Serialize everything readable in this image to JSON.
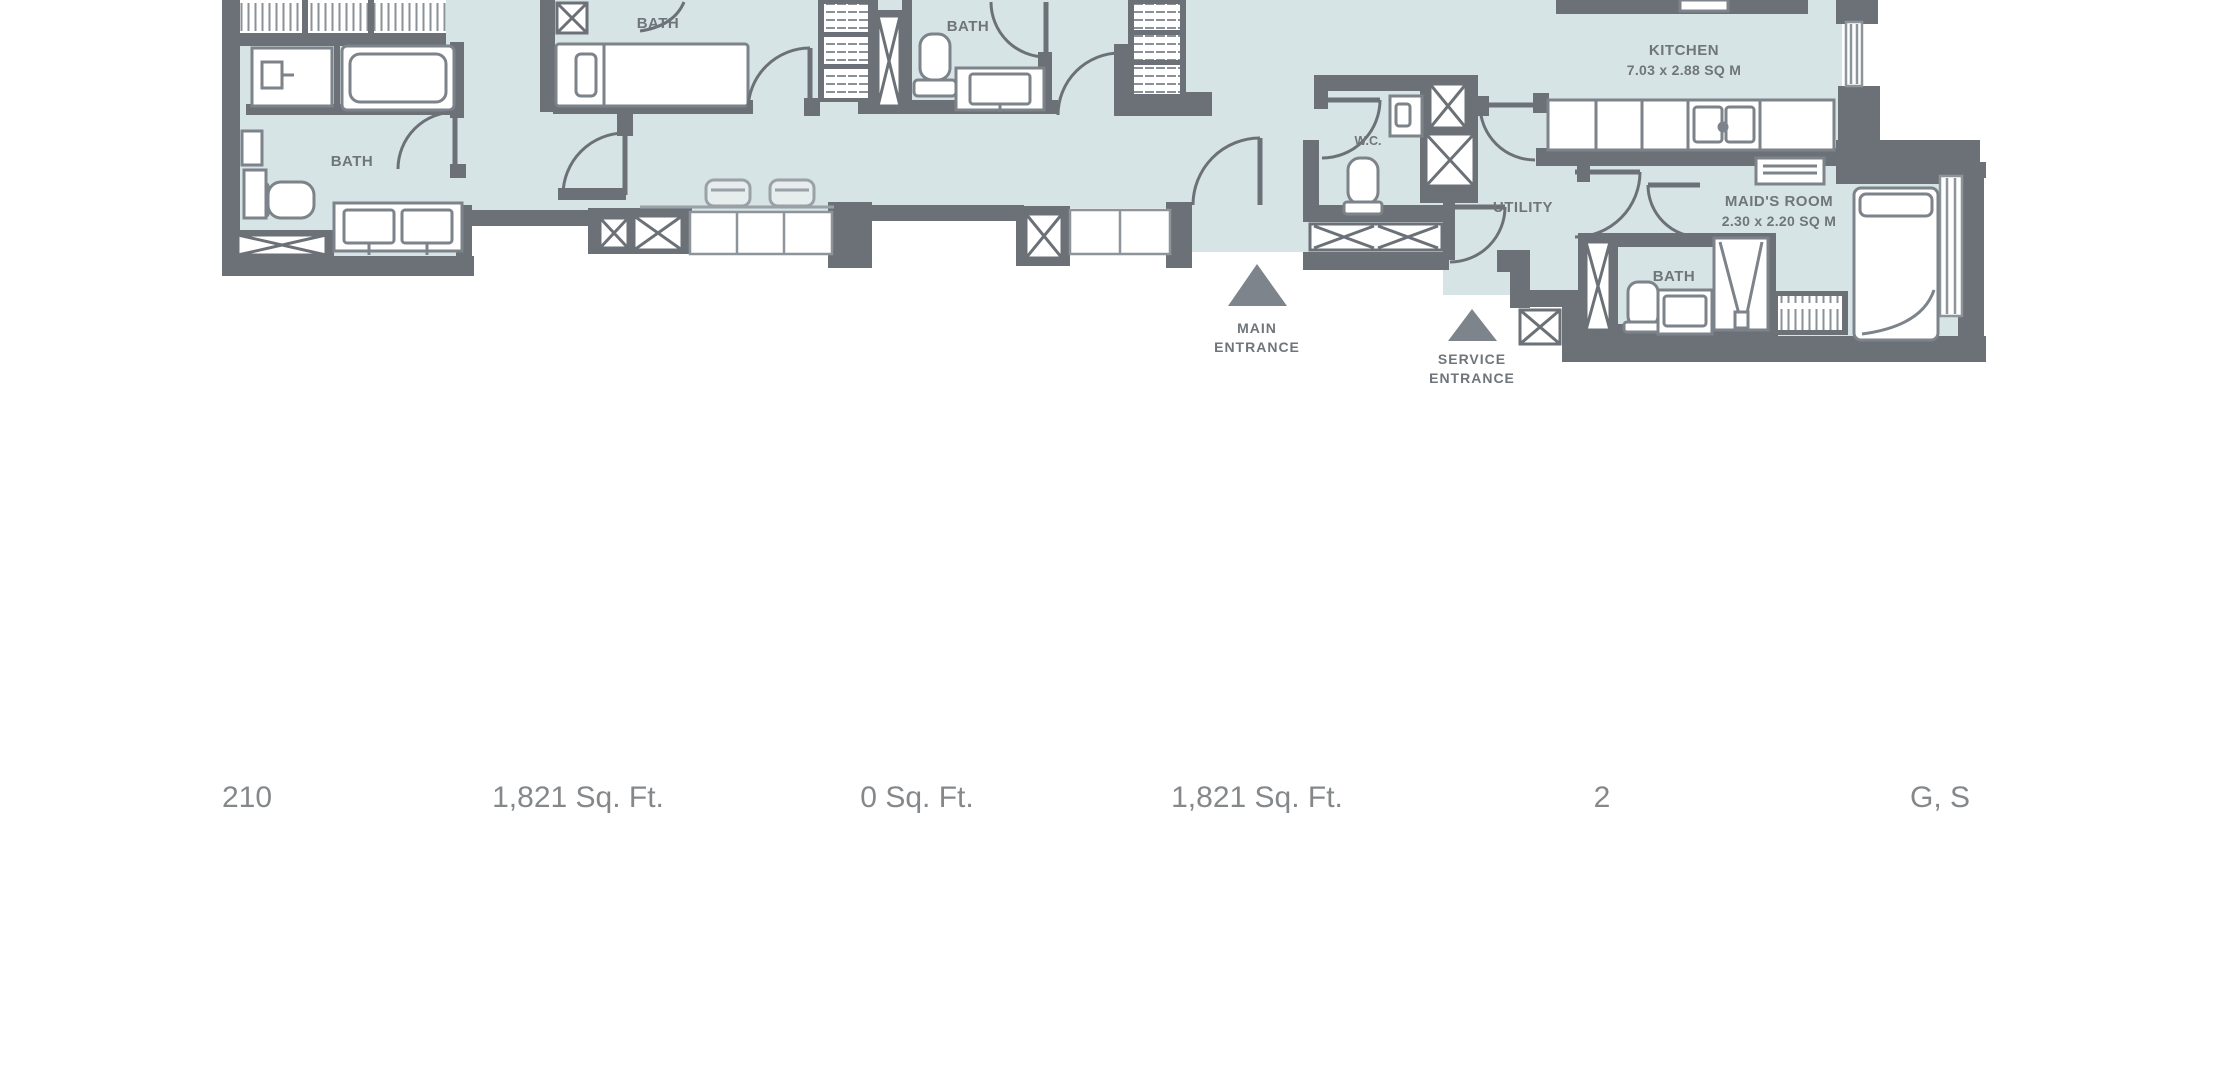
{
  "floor_plan": {
    "labels": {
      "bath_master": "BATH",
      "bath_2": "BATH",
      "bath_3": "BATH",
      "wc": "W.C.",
      "utility": "UTILITY",
      "kitchen_name": "KITCHEN",
      "kitchen_dims": "7.03 x 2.88 SQ M",
      "maids_room_name": "MAID'S ROOM",
      "maids_room_dims": "2.30 x 2.20 SQ M",
      "maids_bath": "BATH",
      "main_entrance_line1": "MAIN",
      "main_entrance_line2": "ENTRANCE",
      "service_entrance_line1": "SERVICE",
      "service_entrance_line2": "ENTRANCE"
    },
    "colors": {
      "wall": "#6b7177",
      "floor": "#d7e4e5",
      "label": "#6f757a",
      "triangle": "#7e848b",
      "fixture_line": "#7c838a"
    }
  },
  "unit_details": {
    "values": [
      "210",
      "1,821 Sq. Ft.",
      "0 Sq. Ft.",
      "1,821 Sq. Ft.",
      "2",
      "G, S"
    ]
  }
}
